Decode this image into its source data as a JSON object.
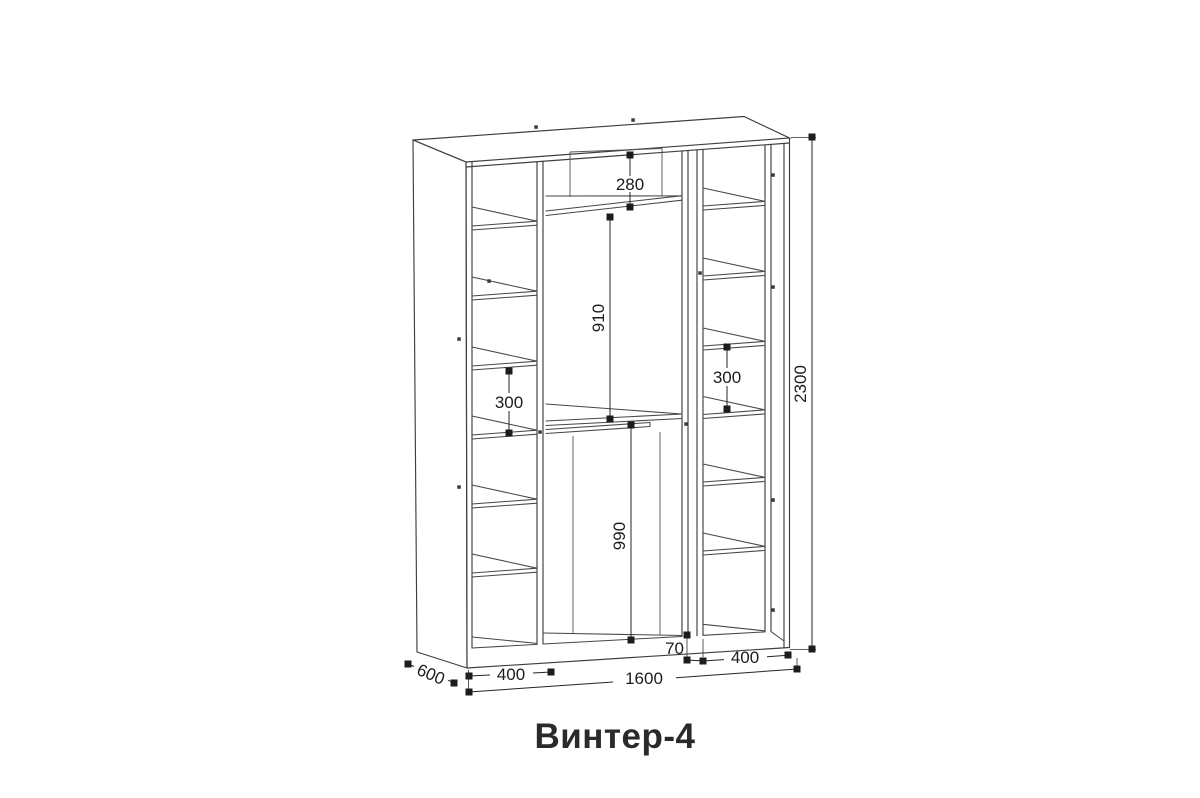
{
  "title": "Винтер-4",
  "dimensions": {
    "top_compartment_height": "280",
    "upper_middle_height": "910",
    "lower_middle_height": "990",
    "left_shelf_spacing": "300",
    "right_shelf_spacing": "300",
    "overall_height": "2300",
    "overall_width": "1600",
    "depth": "600",
    "left_section_width": "400",
    "right_section_width": "400",
    "center_gap": "70"
  }
}
